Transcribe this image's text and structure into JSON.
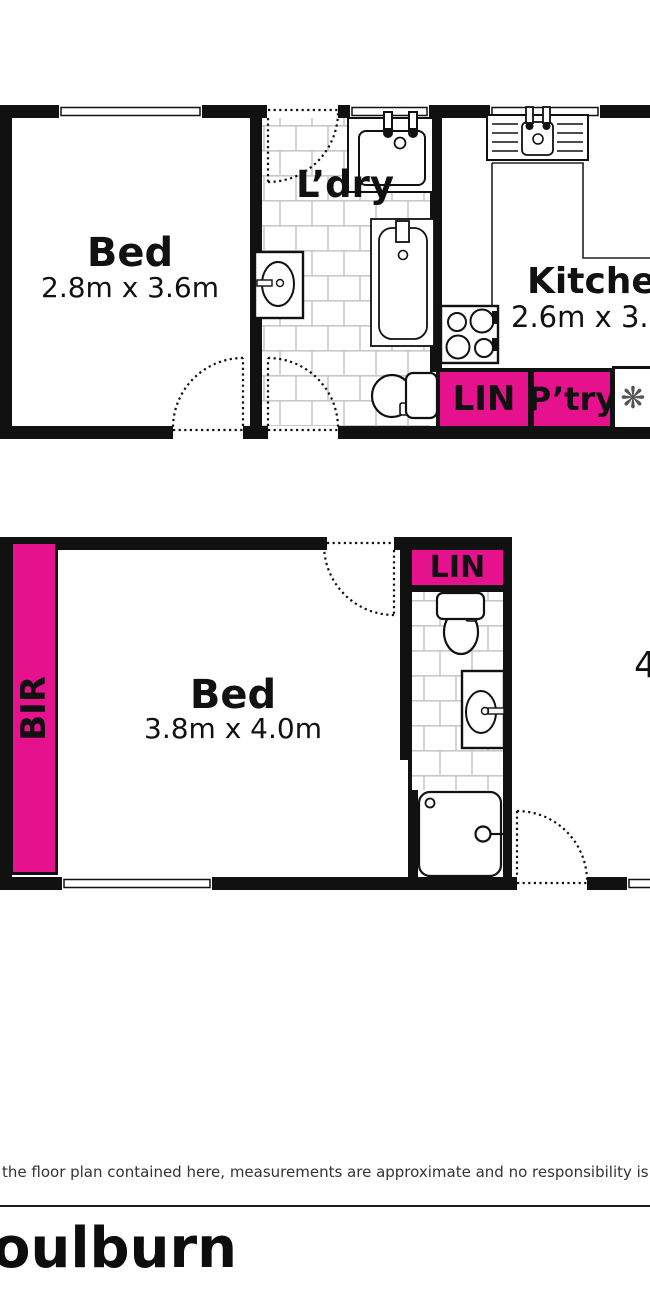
{
  "colors": {
    "accent_magenta": "#E6118D",
    "wall_black": "#111111",
    "tile_grout": "#C9C9C9"
  },
  "upper_plan": {
    "bed": {
      "name": "Bed",
      "dims": "2.8m x 3.6m"
    },
    "laundry": {
      "name": "L’dry"
    },
    "kitchen": {
      "name": "Kitchen",
      "dims": "2.6m x 3.6m"
    },
    "linen": {
      "label": "LIN"
    },
    "pantry": {
      "label": "P’try"
    }
  },
  "lower_plan": {
    "bir": {
      "label": "BIR"
    },
    "linen": {
      "label": "LIN"
    },
    "bed": {
      "name": "Bed",
      "dims": "3.8m x 4.0m"
    },
    "partial_dim": "4"
  },
  "icons": {
    "flower_glyph": "❋"
  },
  "footer": {
    "disclaimer": "the floor plan contained here, measurements are approximate and no responsibility is taken for any er",
    "title": "oulburn"
  }
}
